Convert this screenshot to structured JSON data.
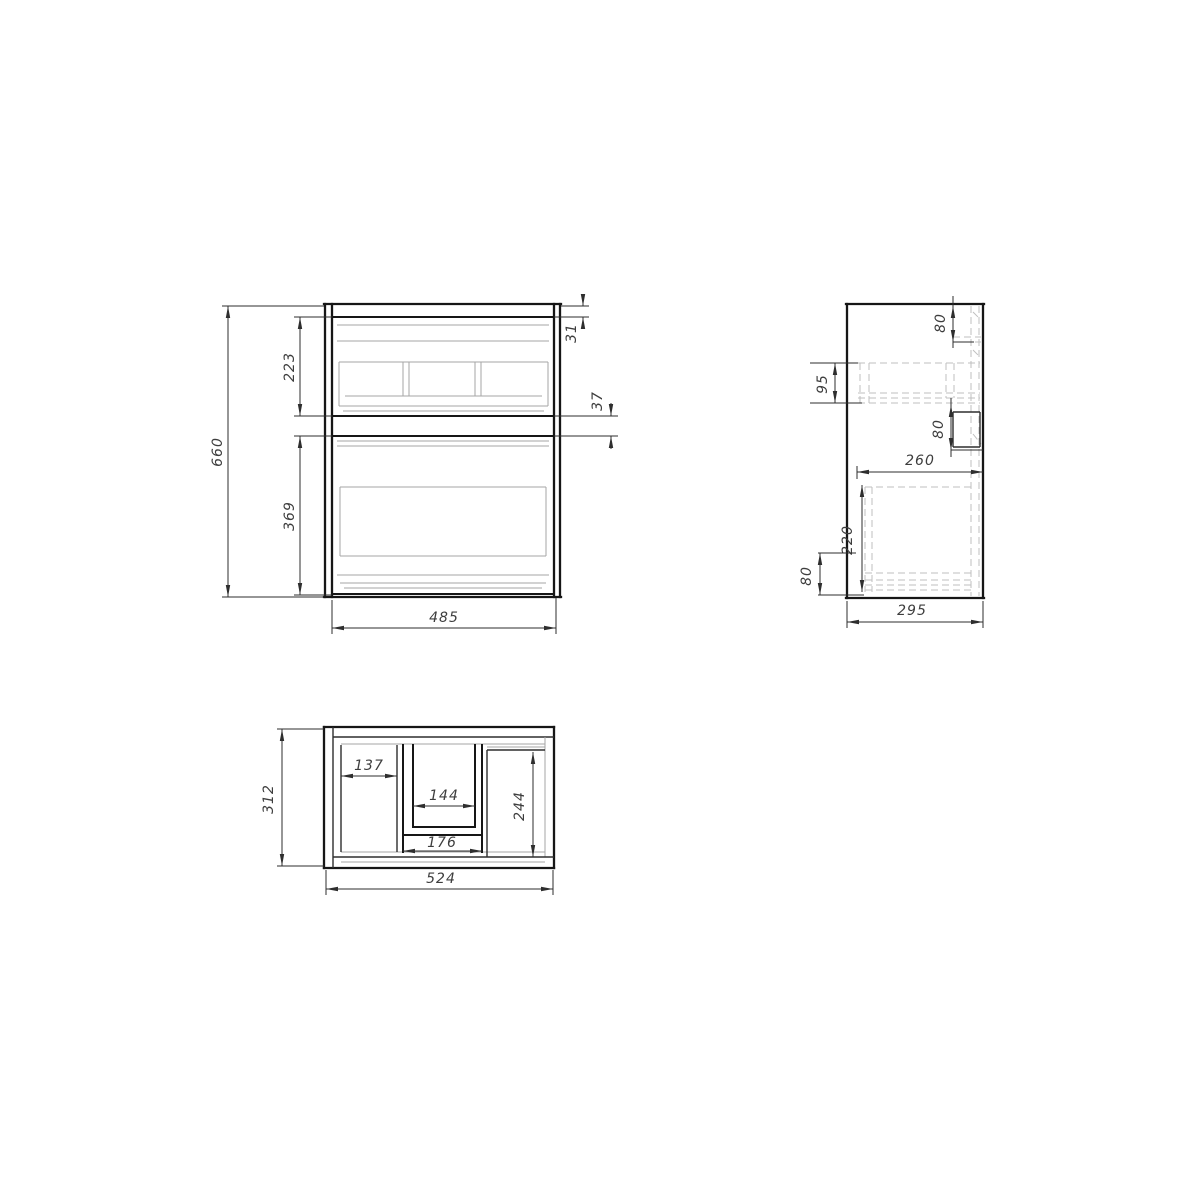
{
  "drawing": {
    "kind": "cabinet three-view technical drawing",
    "views": {
      "front": {
        "dims": {
          "total_height": "660",
          "top_drawer_height": "223",
          "bottom_drawer_height": "369",
          "top_reveal": "31",
          "drawer_gap": "37",
          "front_width": "485"
        }
      },
      "side": {
        "dims": {
          "top_inset": "80",
          "rail_band": "95",
          "mid_inset": "80",
          "inner_depth": "260",
          "box_height": "220",
          "bottom_inset": "80",
          "total_depth": "295"
        }
      },
      "plan": {
        "dims": {
          "total_depth": "312",
          "left_bay_width": "137",
          "cutout_inner_width": "144",
          "right_bay_depth": "244",
          "cutout_outer_width": "176",
          "total_width": "524"
        }
      }
    }
  },
  "colors": {
    "background": "#ffffff",
    "outline": "#161616",
    "detail": "#a6a6a6",
    "hidden": "#bfbfbf",
    "dimension": "#2e2e2e",
    "text": "#3d3d3d"
  }
}
